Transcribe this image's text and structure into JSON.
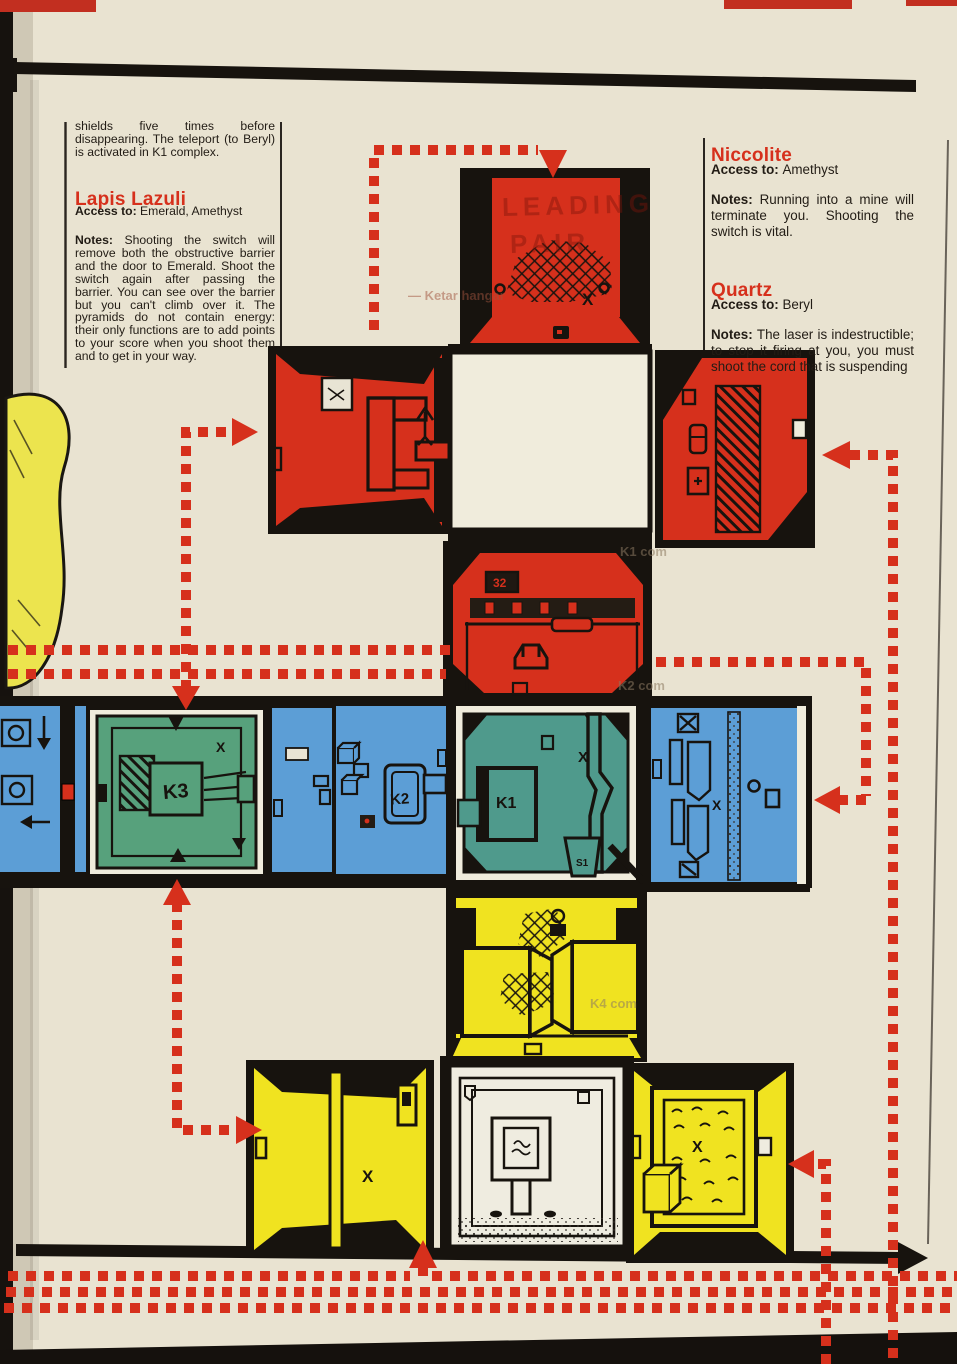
{
  "colors": {
    "paper": "#e9e3d1",
    "accent_red": "#d6301c",
    "room_red": "#d6301c",
    "room_blue": "#5c9ed6",
    "room_green": "#57a17c",
    "room_teal": "#4f9a8c",
    "room_yellow": "#f0e320",
    "ink_black": "#17130e"
  },
  "left_column": {
    "intro": "shields five times before disappearing. The teleport (to Beryl) is activated in K1 complex.",
    "section": {
      "title": "Lapis Lazuli",
      "access_label": "Access to:",
      "access": "Emerald, Amethyst",
      "notes_label": "Notes:",
      "notes": "Shooting the switch will remove both the obstructive barrier and the door to Emerald. Shoot the switch again after passing the barrier. You can see over the barrier but you can't climb over it. The pyramids do not contain energy: their only functions are to add points to your score when you shoot them and to get in your way."
    }
  },
  "right_column": {
    "sections": [
      {
        "title": "Niccolite",
        "access_label": "Access to:",
        "access": "Amethyst",
        "notes_label": "Notes:",
        "notes": "Running into a mine will terminate you. Shooting the switch is vital."
      },
      {
        "title": "Quartz",
        "access_label": "Access to:",
        "access": "Beryl",
        "notes_label": "Notes:",
        "notes": "The laser is indestructible; to stop it firing at you, you must shoot the cord that is suspending"
      }
    ]
  },
  "map_labels": {
    "k1": "K1",
    "k2": "K2",
    "k3": "K3",
    "s1": "S1",
    "badge32": "32",
    "x": "X"
  },
  "ghost_texts": {
    "leading": "LEADING",
    "pair": "PAIR",
    "ketar": "— Ketar hangar",
    "k1com": "K1 com",
    "k2com": "K2 com",
    "k4com": "K4 com"
  }
}
